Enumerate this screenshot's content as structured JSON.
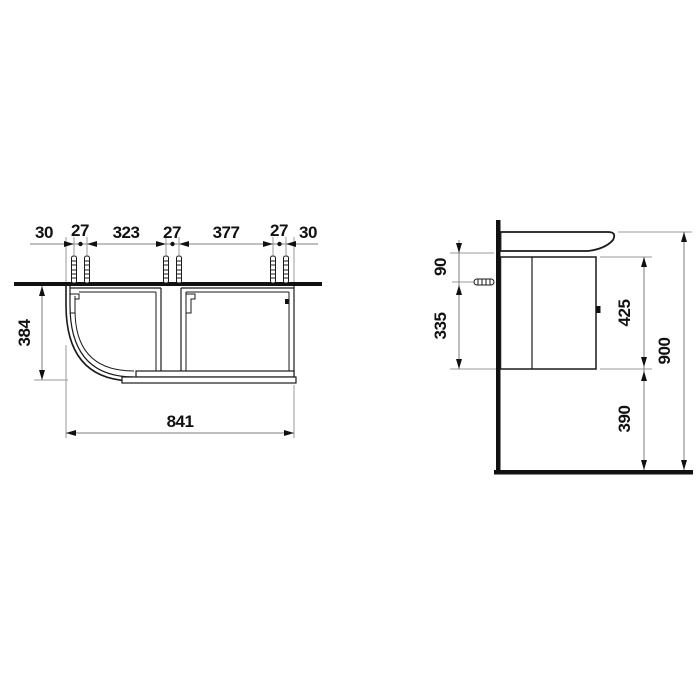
{
  "drawing_colors": {
    "object_line": "#1a1a1a",
    "dimension_line": "#7d7d7d",
    "text": "#111111",
    "background": "#ffffff"
  },
  "plan_view": {
    "chain": [
      "30",
      "27",
      "323",
      "27",
      "377",
      "27",
      "30"
    ],
    "depth": "384",
    "width": "841"
  },
  "side_view": {
    "basin_to_bolt": "90",
    "bolt_to_cabinet_bottom": "335",
    "cabinet_height": "425",
    "floor_clearance": "390",
    "total_height": "900"
  }
}
